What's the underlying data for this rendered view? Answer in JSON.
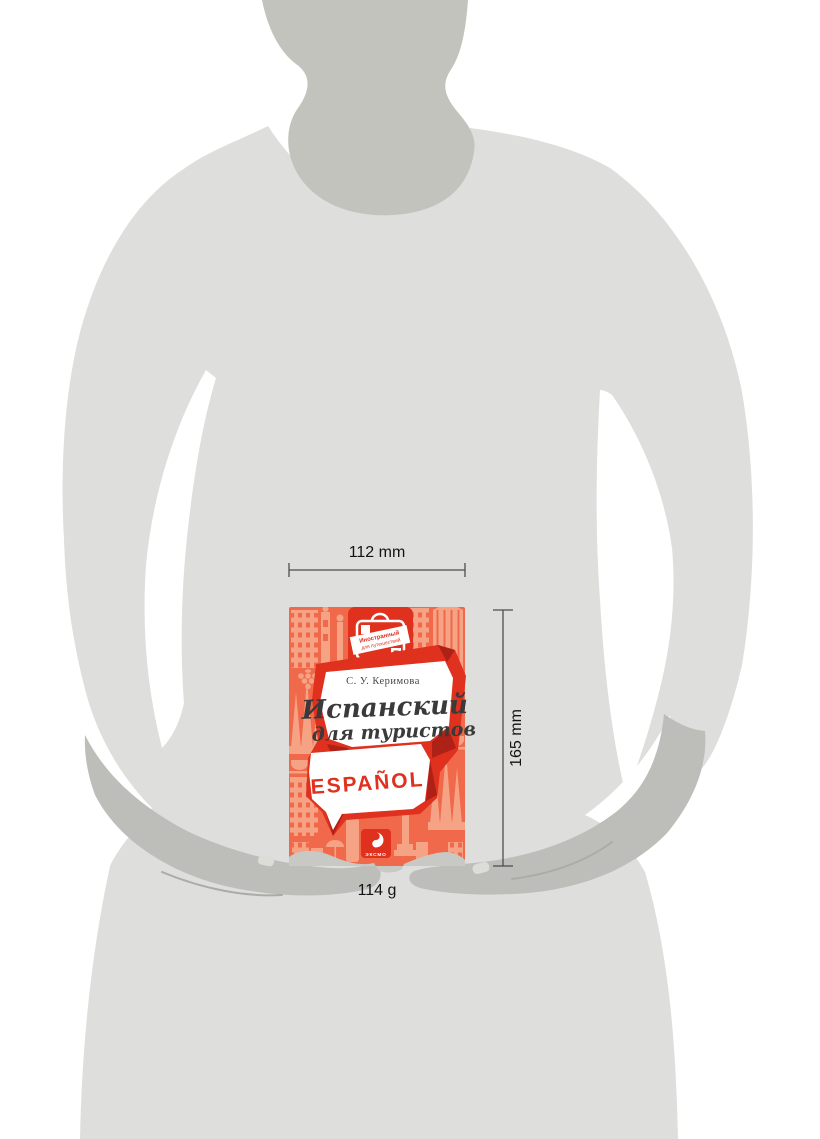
{
  "scene": {
    "description_labels": [],
    "person": "silhouette-holding-book"
  },
  "book": {
    "author": "С. У. Керимова",
    "title_line1": "Испанский",
    "title_line2": "для туристов",
    "cover_word": "ESPAÑOL",
    "series_badge_line1": "Иностранный",
    "series_badge_line2": "для путешествий",
    "publisher": "ЭКСМО"
  },
  "dimensions": {
    "width_label": "112 mm",
    "height_label": "165 mm",
    "weight_label": "114 g"
  },
  "icons": {
    "series_badge": "suitcase-icon",
    "publisher_logo": "eksmo-swirl-icon",
    "title_shape": "speech-bubble",
    "cover_word_shape": "speech-bubble"
  },
  "colors": {
    "cover_orange": "#F0694A",
    "cover_pattern": "#F6A285",
    "accent_red": "#E0301E",
    "dark_red": "#AD2117",
    "body_gray": "#DEDEDC",
    "neck_gray": "#C3C3BE",
    "hand_gray": "#BDBDB9",
    "finger_gray": "#C8C8C4",
    "dimension_line": "#4D4D4D"
  }
}
